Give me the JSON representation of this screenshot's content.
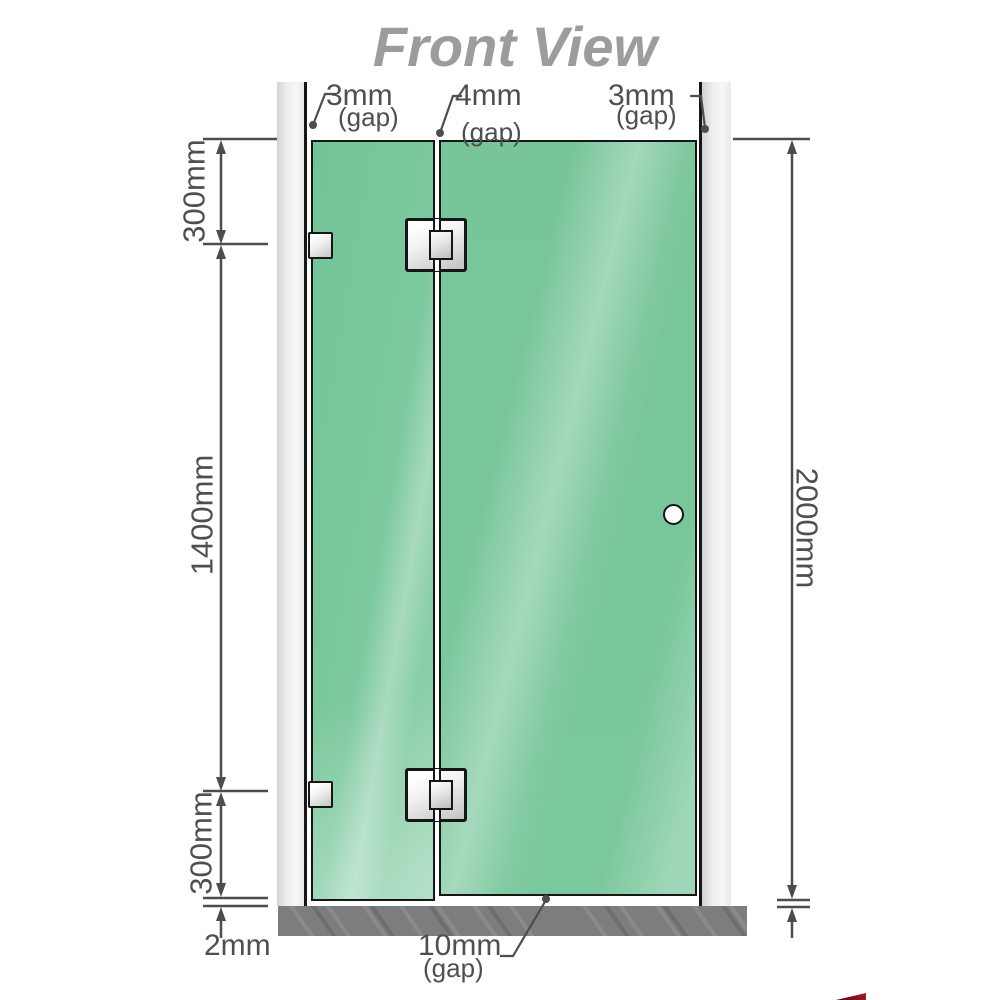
{
  "title": "Front View",
  "annotations": {
    "gap_left": "3mm",
    "gap_left_sub": "(gap)",
    "gap_middle": "4mm",
    "gap_middle_sub": "(gap)",
    "gap_right": "3mm",
    "gap_right_sub": "(gap)",
    "segment_top": "300mm",
    "segment_middle": "1400mm",
    "segment_bottom": "300mm",
    "total_height": "2000mm",
    "floor_clearance": "2mm",
    "door_floor_gap": "10mm",
    "door_floor_gap_sub": "(gap)"
  },
  "colors": {
    "glass_green": "#7cc89e",
    "glass_highlight": "#9cd8b7",
    "outline_black": "#161616",
    "dimension_gray": "#4d4d4d",
    "title_gray": "#9c9c9c",
    "wall_gray": "#ededed",
    "floor_gray": "#7d7d7d",
    "hardware_silver": "#e8e8e8",
    "logo_red": "#9e1b2a"
  }
}
